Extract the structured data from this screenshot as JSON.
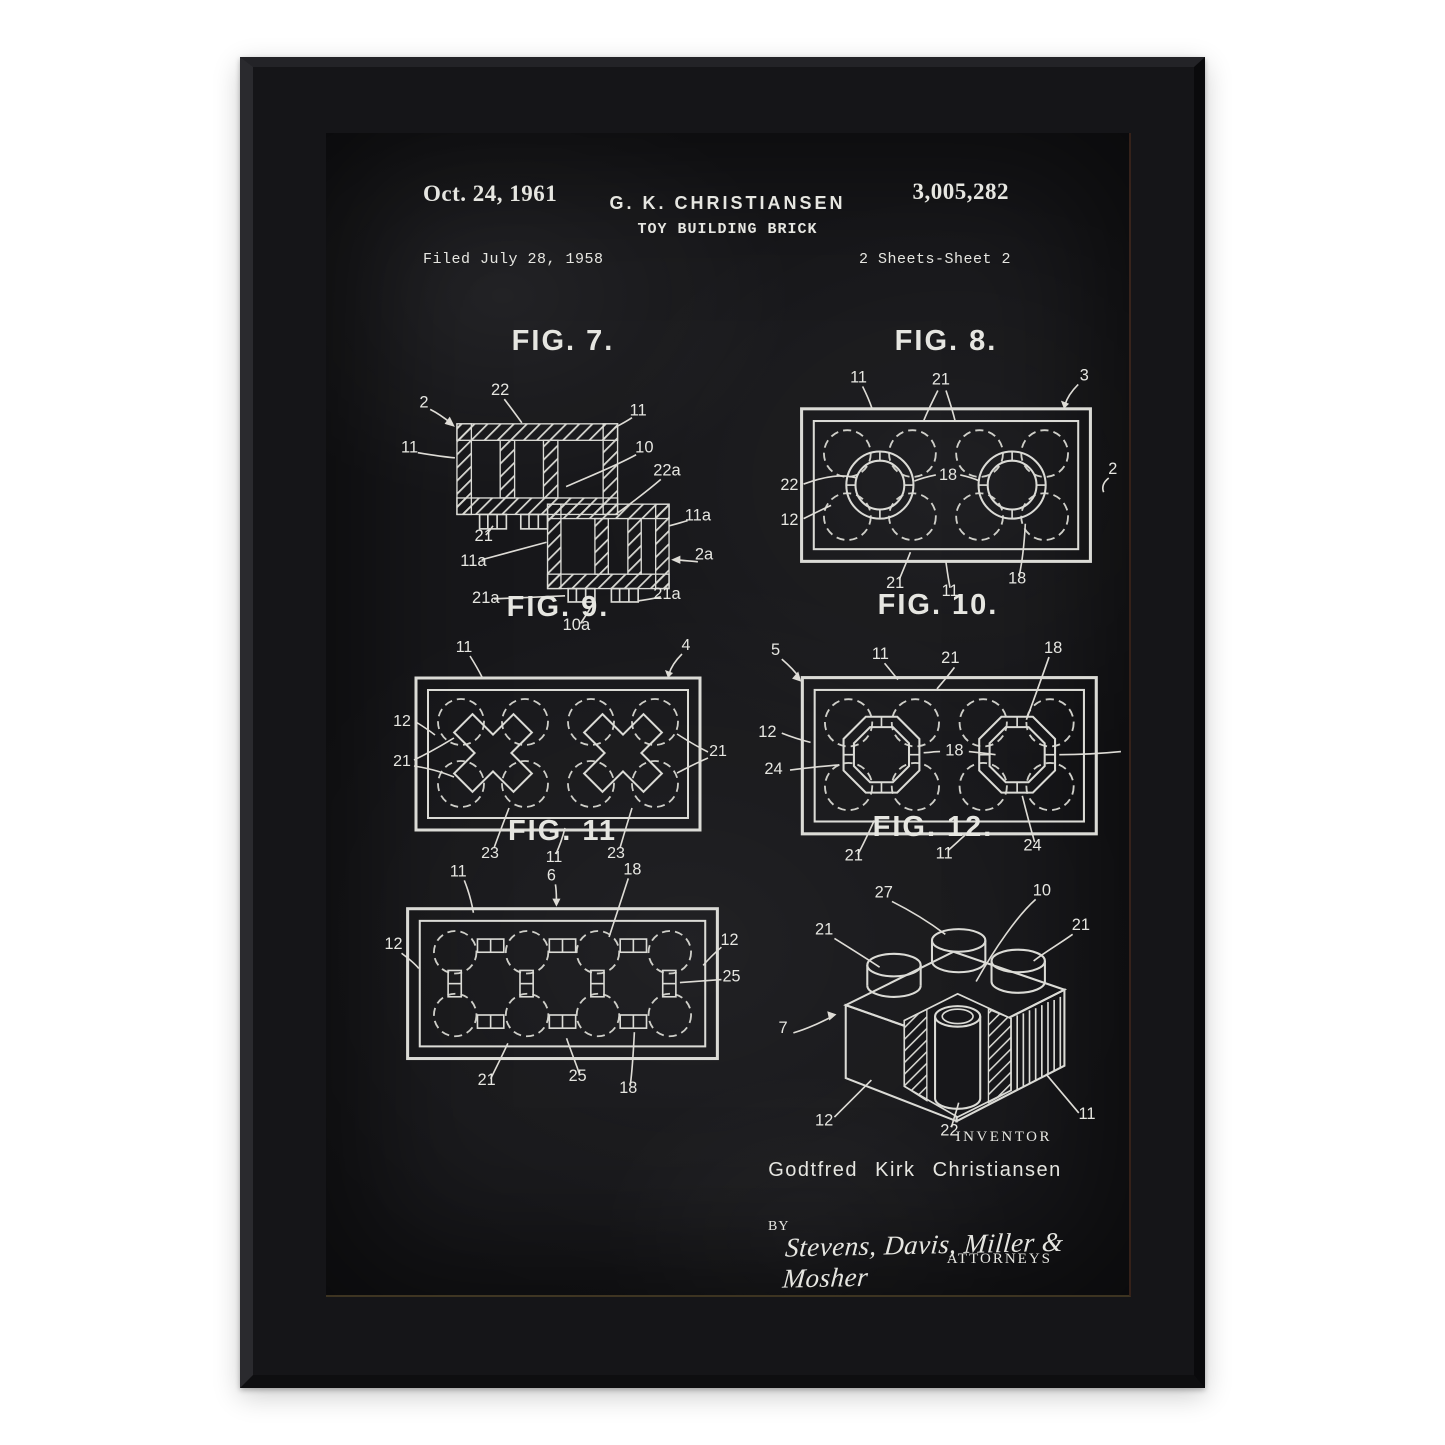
{
  "poster": {
    "colors": {
      "background": "#17171a",
      "ink": "#e6e6e1",
      "frame": "#151518"
    }
  },
  "header": {
    "date": "Oct. 24, 1961",
    "inventor_short": "G. K. CHRISTIANSEN",
    "patent_title": "TOY BUILDING BRICK",
    "patent_number": "3,005,282",
    "filed": "Filed July 28, 1958",
    "sheet": "2 Sheets-Sheet 2"
  },
  "figures": [
    {
      "id": "fig7",
      "title": "FIG. 7.",
      "labels": [
        {
          "t": "2",
          "x": 30,
          "y": 46
        },
        {
          "t": "22",
          "x": 104,
          "y": 34
        },
        {
          "t": "11",
          "x": 238,
          "y": 54
        },
        {
          "t": "11",
          "x": 16,
          "y": 90
        },
        {
          "t": "10",
          "x": 244,
          "y": 90
        },
        {
          "t": "22a",
          "x": 266,
          "y": 112
        },
        {
          "t": "21",
          "x": 88,
          "y": 176
        },
        {
          "t": "11a",
          "x": 296,
          "y": 156
        },
        {
          "t": "11a",
          "x": 78,
          "y": 200
        },
        {
          "t": "2a",
          "x": 302,
          "y": 194
        },
        {
          "t": "21a",
          "x": 90,
          "y": 236
        },
        {
          "t": "10a",
          "x": 178,
          "y": 262
        },
        {
          "t": "21a",
          "x": 266,
          "y": 232
        }
      ]
    },
    {
      "id": "fig8",
      "title": "FIG. 8.",
      "labels": [
        {
          "t": "11",
          "x": 84,
          "y": 22
        },
        {
          "t": "21",
          "x": 165,
          "y": 24
        },
        {
          "t": "3",
          "x": 306,
          "y": 20
        },
        {
          "t": "22",
          "x": 16,
          "y": 128
        },
        {
          "t": "18",
          "x": 172,
          "y": 118
        },
        {
          "t": "12",
          "x": 16,
          "y": 162
        },
        {
          "t": "2",
          "x": 334,
          "y": 112
        },
        {
          "t": "21",
          "x": 120,
          "y": 224
        },
        {
          "t": "11",
          "x": 174,
          "y": 232
        },
        {
          "t": "18",
          "x": 240,
          "y": 220
        }
      ]
    },
    {
      "id": "fig9",
      "title": "FIG. 9.",
      "labels": [
        {
          "t": "11",
          "x": 76,
          "y": 26
        },
        {
          "t": "4",
          "x": 298,
          "y": 24
        },
        {
          "t": "12",
          "x": 14,
          "y": 100
        },
        {
          "t": "21",
          "x": 14,
          "y": 140
        },
        {
          "t": "21",
          "x": 330,
          "y": 130
        },
        {
          "t": "23",
          "x": 102,
          "y": 232
        },
        {
          "t": "11",
          "x": 166,
          "y": 236
        },
        {
          "t": "23",
          "x": 228,
          "y": 232
        }
      ]
    },
    {
      "id": "fig10",
      "title": "FIG. 10.",
      "labels": [
        {
          "t": "5",
          "x": 22,
          "y": 30
        },
        {
          "t": "11",
          "x": 124,
          "y": 34
        },
        {
          "t": "21",
          "x": 192,
          "y": 38
        },
        {
          "t": "18",
          "x": 292,
          "y": 28
        },
        {
          "t": "12",
          "x": 14,
          "y": 110
        },
        {
          "t": "24",
          "x": 20,
          "y": 146
        },
        {
          "t": "18",
          "x": 196,
          "y": 128
        },
        {
          "t": "21",
          "x": 98,
          "y": 230
        },
        {
          "t": "11",
          "x": 186,
          "y": 228
        },
        {
          "t": "24",
          "x": 272,
          "y": 220
        }
      ]
    },
    {
      "id": "fig11",
      "title": "FIG. 11",
      "labels": [
        {
          "t": "11",
          "x": 72,
          "y": 26
        },
        {
          "t": "6",
          "x": 164,
          "y": 30
        },
        {
          "t": "18",
          "x": 244,
          "y": 24
        },
        {
          "t": "12",
          "x": 8,
          "y": 98
        },
        {
          "t": "12",
          "x": 340,
          "y": 94
        },
        {
          "t": "25",
          "x": 342,
          "y": 130
        },
        {
          "t": "21",
          "x": 100,
          "y": 232
        },
        {
          "t": "25",
          "x": 190,
          "y": 228
        },
        {
          "t": "18",
          "x": 240,
          "y": 240
        }
      ]
    },
    {
      "id": "fig12",
      "title": "FIG. 12.",
      "labels": [
        {
          "t": "27",
          "x": 132,
          "y": 50
        },
        {
          "t": "10",
          "x": 286,
          "y": 48
        },
        {
          "t": "21",
          "x": 74,
          "y": 86
        },
        {
          "t": "21",
          "x": 324,
          "y": 82
        },
        {
          "t": "7",
          "x": 34,
          "y": 182
        },
        {
          "t": "12",
          "x": 74,
          "y": 272
        },
        {
          "t": "22",
          "x": 196,
          "y": 282
        },
        {
          "t": "11",
          "x": 330,
          "y": 266
        }
      ]
    }
  ],
  "footer": {
    "inventor_caption": "INVENTOR",
    "inventor_full": "Godtfred Kirk Christiansen",
    "by": "BY",
    "signature": "Stevens, Davis, Miller & Mosher",
    "attorneys": "ATTORNEYS"
  }
}
